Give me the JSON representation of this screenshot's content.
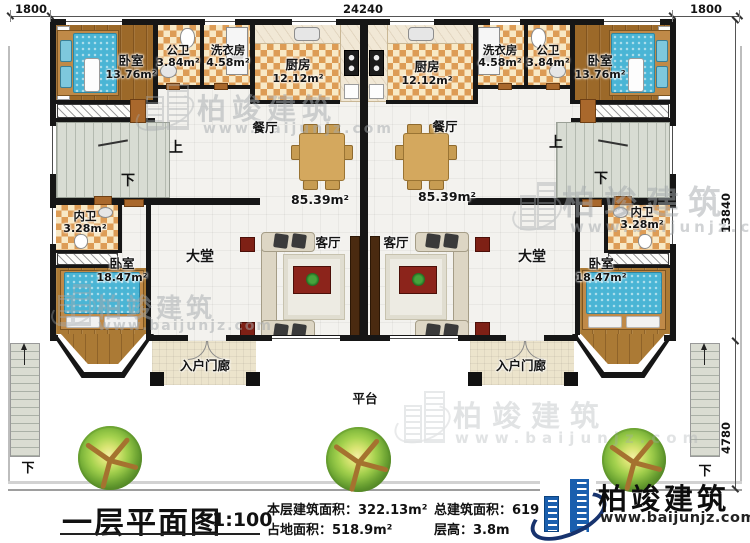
{
  "plan": {
    "dimensions": {
      "top_left": "1800",
      "top_center": "24240",
      "top_right": "1800",
      "right_upper": "13840",
      "right_lower": "4780"
    },
    "stair_labels": {
      "up": "上",
      "down": "下"
    },
    "outdoor": {
      "platform": "平台",
      "stairs_down": "下"
    },
    "rooms": {
      "bedroom_top": {
        "name": "卧室",
        "area": "13.76m²"
      },
      "public_bath": {
        "name": "公卫",
        "area": "3.84m²"
      },
      "laundry": {
        "name": "洗衣房",
        "area": "4.58m²"
      },
      "kitchen": {
        "name": "厨房",
        "area": "12.12m²"
      },
      "dining": {
        "name": "餐厅"
      },
      "living": {
        "name": "客厅"
      },
      "hall": {
        "name": "大堂"
      },
      "inner_bath": {
        "name": "内卫",
        "area": "3.28m²"
      },
      "bedroom_lower": {
        "name": "卧室",
        "area": "18.47m²"
      },
      "porch": {
        "name": "入户门廊"
      },
      "unit_area": "85.39m²"
    }
  },
  "title_block": {
    "title": "一层平面图",
    "scale": "1:100",
    "stats": [
      {
        "label": "本层建筑面积：",
        "value": "322.13m²"
      },
      {
        "label": "占地面积：",
        "value": "518.9m²"
      },
      {
        "label": "总建筑面积：",
        "value": "619.63m²"
      },
      {
        "label": "层高：",
        "value": "3.8m"
      }
    ]
  },
  "branding": {
    "name": "柏竣建筑",
    "url": "www.baijunjz.com"
  }
}
